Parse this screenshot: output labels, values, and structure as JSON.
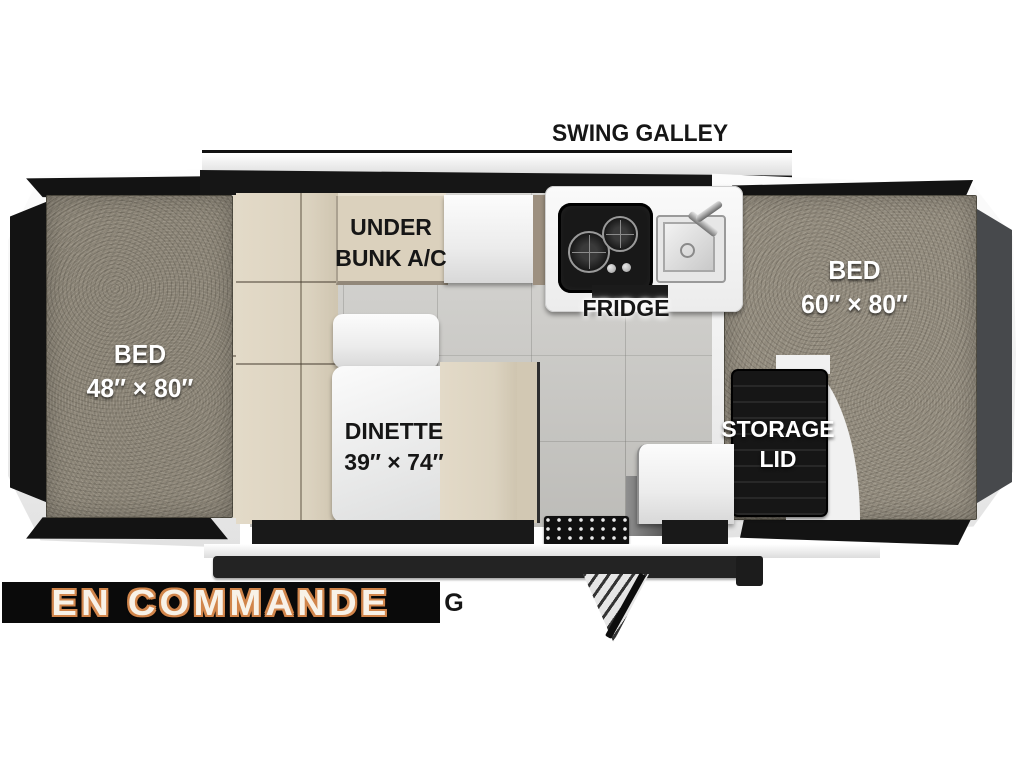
{
  "floorplan": {
    "swing_galley": {
      "label": "SWING GALLEY"
    },
    "beds": {
      "left": {
        "label": "BED",
        "dim": "48″ × 80″"
      },
      "right": {
        "label": "BED",
        "dim": "60″ × 80″"
      }
    },
    "under_bunk_ac": {
      "line1": "UNDER",
      "line2": "BUNK A/C"
    },
    "fridge": {
      "label": "FRIDGE"
    },
    "dinette": {
      "label": "DINETTE",
      "dim": "39″ × 74″"
    },
    "storage": {
      "line1": "STORAGE",
      "line2": "LID"
    }
  },
  "overlay": {
    "status_banner": "EN COMMANDE",
    "partial_text": "G"
  },
  "colors": {
    "banner_bg": "#0a0a0a",
    "banner_text": "#f8f2e8",
    "banner_outline": "#d1854b",
    "mattress": "#8d8678",
    "cabinet_beige": "#ddd4c1",
    "floor_tile": "#c9c8c4",
    "tent_panel_black": "#131313",
    "side_panel_gray": "#47494c"
  }
}
